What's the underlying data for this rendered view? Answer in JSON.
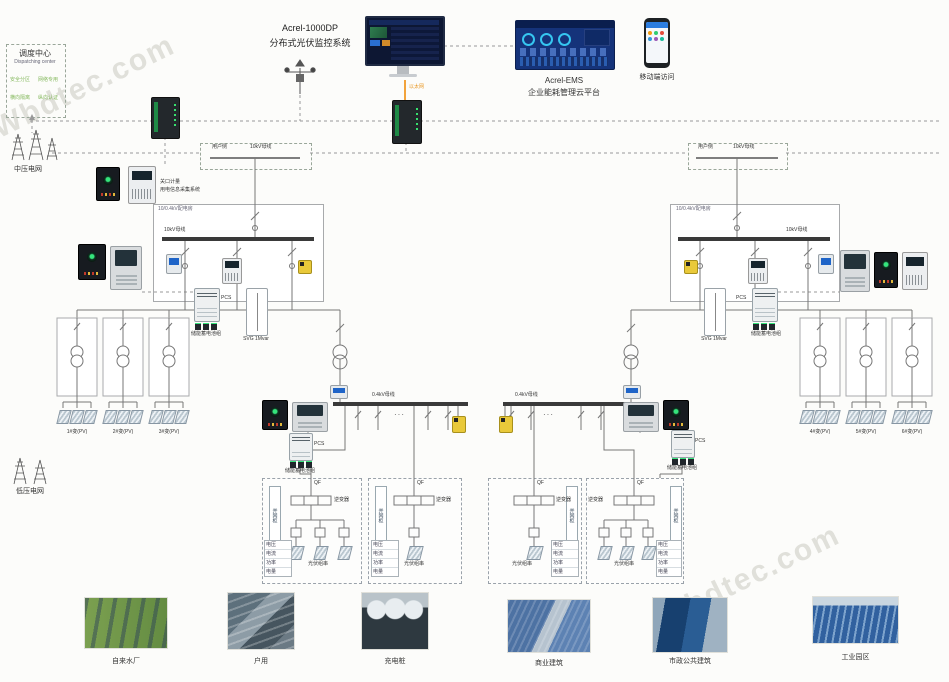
{
  "watermark": "Wbdtec.com",
  "dispatch": {
    "title": "调度中心",
    "subtitle": "Dispatching center",
    "items": [
      "安全分区",
      "网络专用",
      "横向隔离",
      "纵向认证"
    ]
  },
  "grids": {
    "medium": "中压电网",
    "low": "低压电网"
  },
  "platform": {
    "scada_name": "Acrel-1000DP",
    "scada_desc": "分布式光伏监控系统",
    "ems_name": "Acrel-EMS",
    "ems_desc": "企业能耗管理云平台",
    "mobile": "移动端访问",
    "link": "以太网"
  },
  "metering": {
    "line1": "关口计量",
    "line2": "用电信息采集系统"
  },
  "station": {
    "user_side": "用户侧",
    "bus10_label": "10kV母线",
    "room_label": "10/0.4kV配电房",
    "bus10_inner": "10kV母线",
    "bus04": "0.4kV母线",
    "dots": "···"
  },
  "storage": {
    "pcs": "PCS",
    "battery": "储能蓄电池组",
    "svg": "SVG 1Mvar"
  },
  "transformers": {
    "left": [
      "1#变(PV)",
      "2#变(PV)",
      "3#变(PV)"
    ],
    "right": [
      "4#变(PV)",
      "5#变(PV)",
      "6#变(PV)"
    ]
  },
  "inverter_box": {
    "side": "并网柜",
    "switch": "QF",
    "inverter": "逆变器",
    "pv": "光伏组串",
    "legend": [
      "电压",
      "电流",
      "功率",
      "电量"
    ]
  },
  "photos": [
    "自来水厂",
    "户用",
    "充电桩",
    "商业建筑",
    "市政公共建筑",
    "工业园区"
  ]
}
